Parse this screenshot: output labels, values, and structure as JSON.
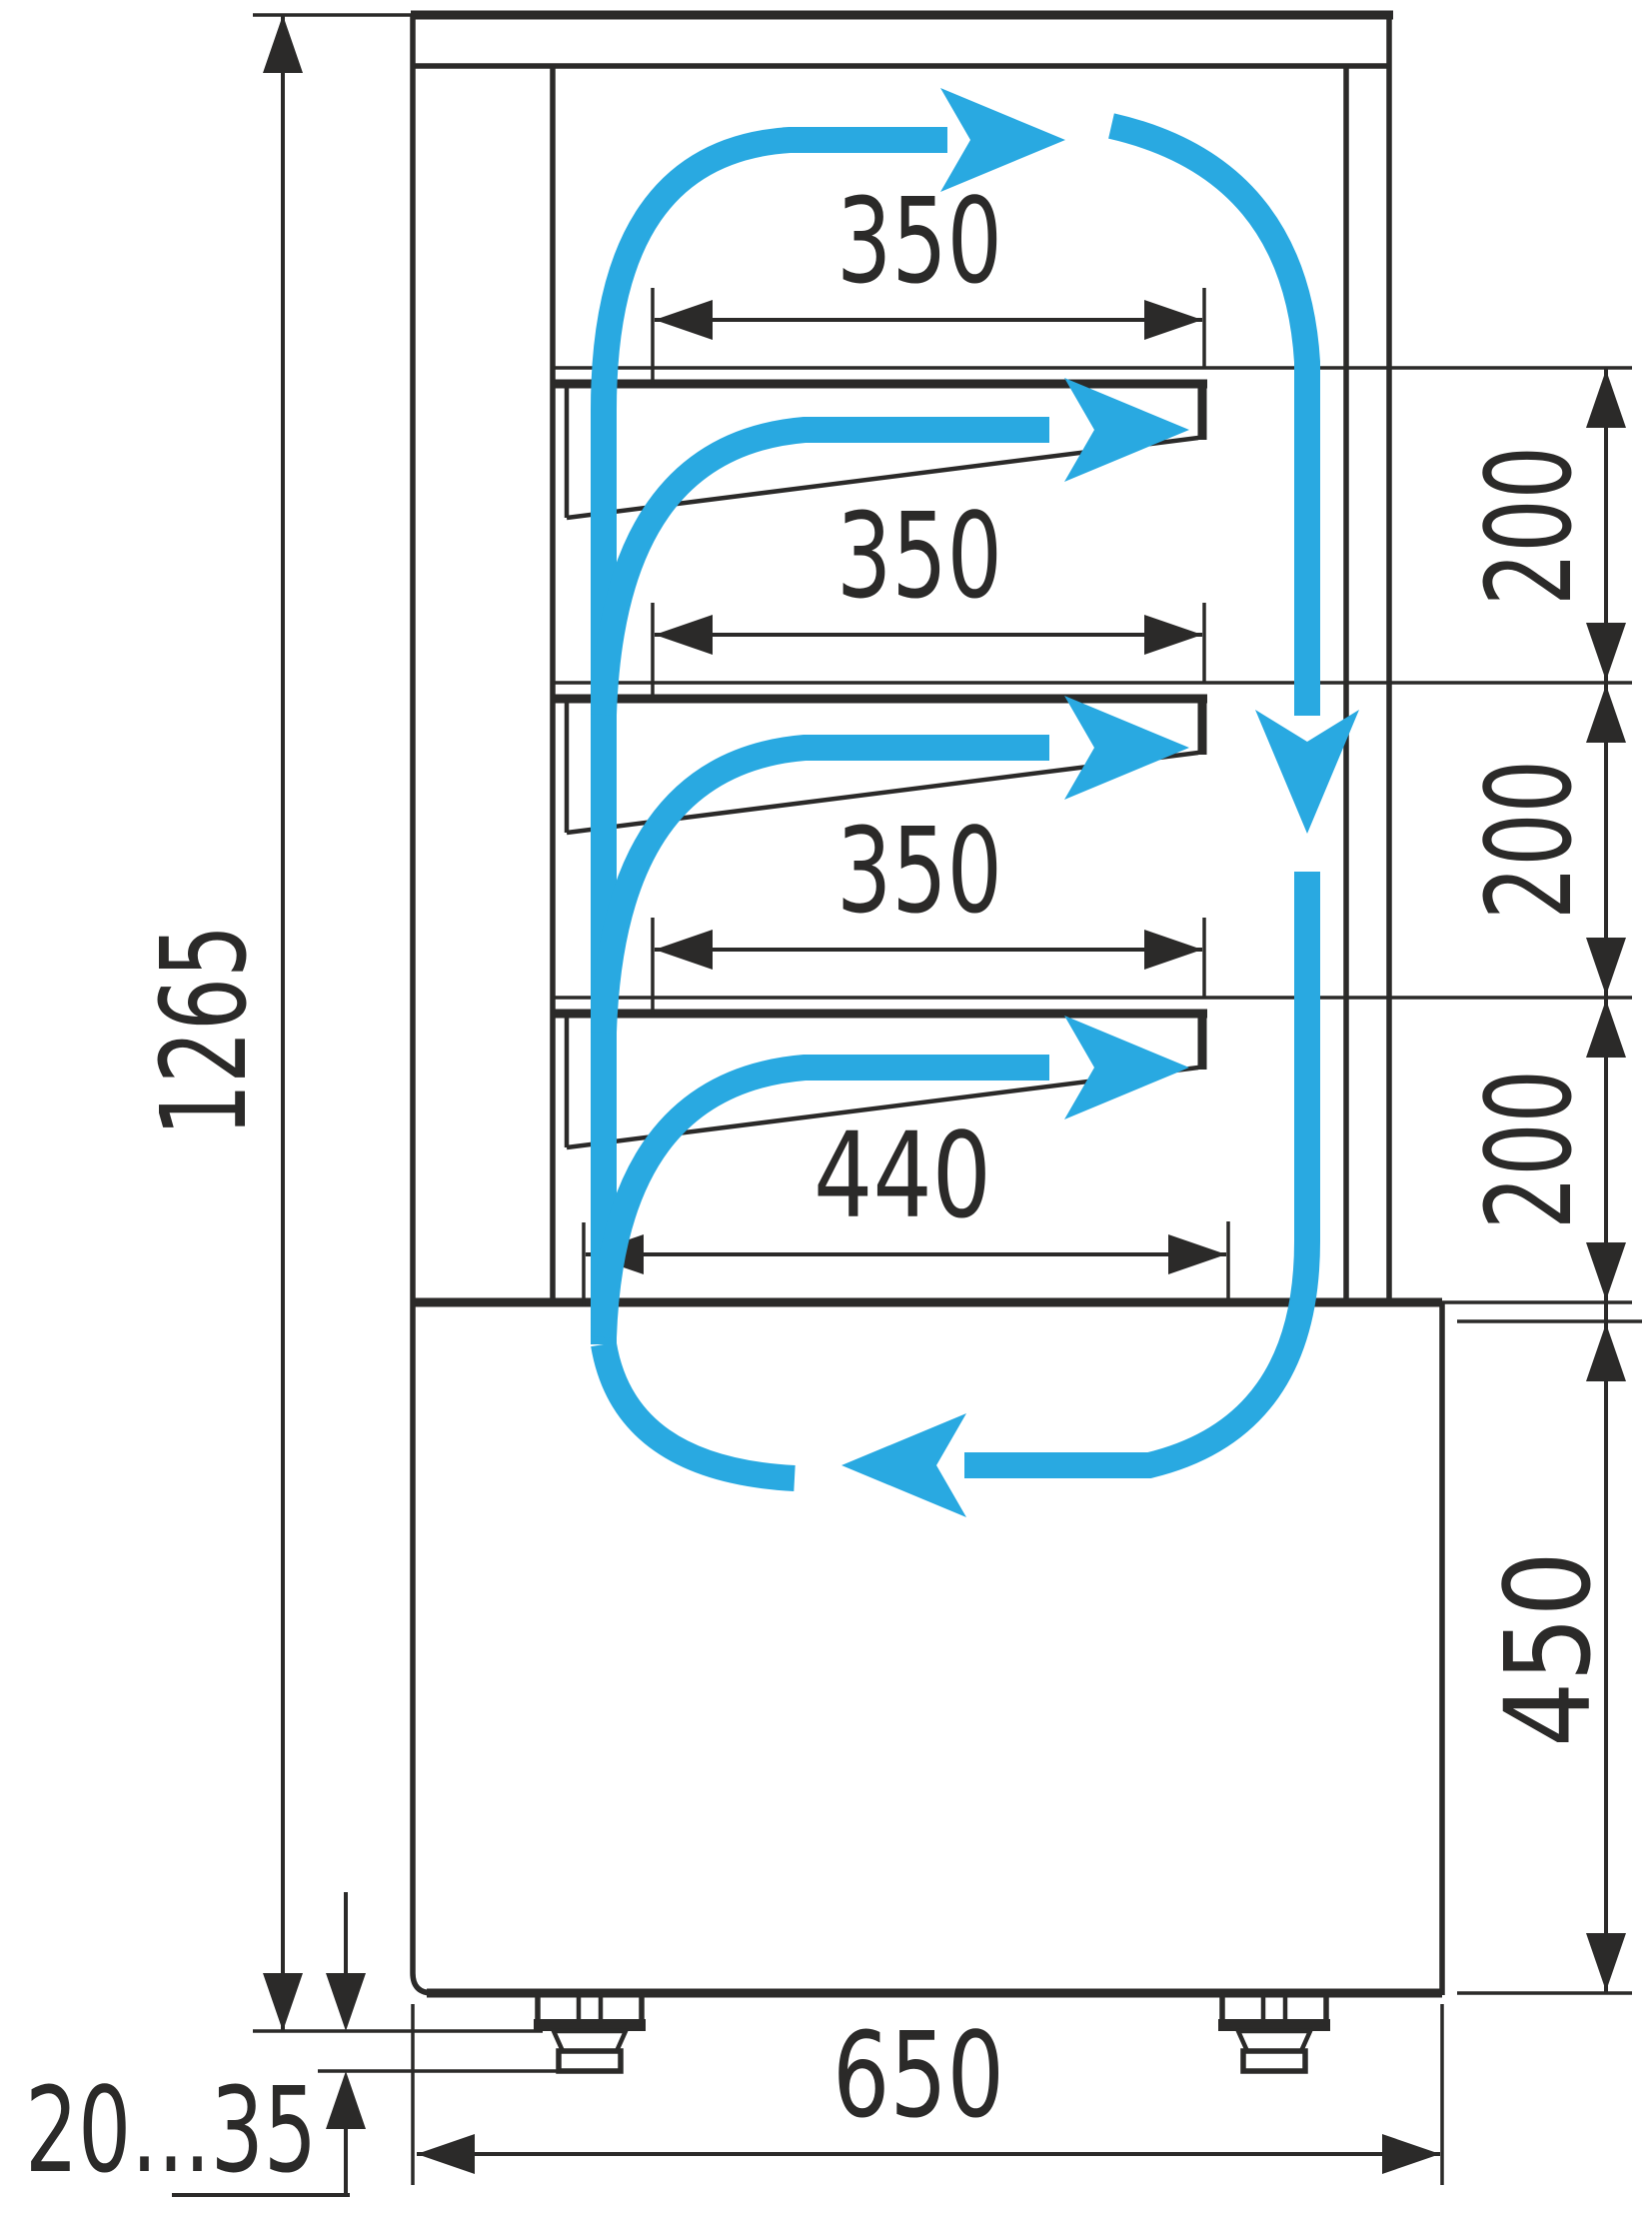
{
  "title": "Refrigerated confectionery display case — side section with airflow and dimensions (mm)",
  "colors": {
    "ink": "#2b2a29",
    "accent": "#29a9e1",
    "background": "#ffffff"
  },
  "dimensions": {
    "total_height": "1265",
    "shelf_depth_top": "350",
    "shelf_depth_middle": "350",
    "shelf_depth_lower": "350",
    "bottom_shelf_depth": "440",
    "shelf_gap_1": "200",
    "shelf_gap_2": "200",
    "shelf_gap_3": "200",
    "base_section_height": "450",
    "base_depth": "650",
    "foot_adjust_range": "20...35"
  }
}
